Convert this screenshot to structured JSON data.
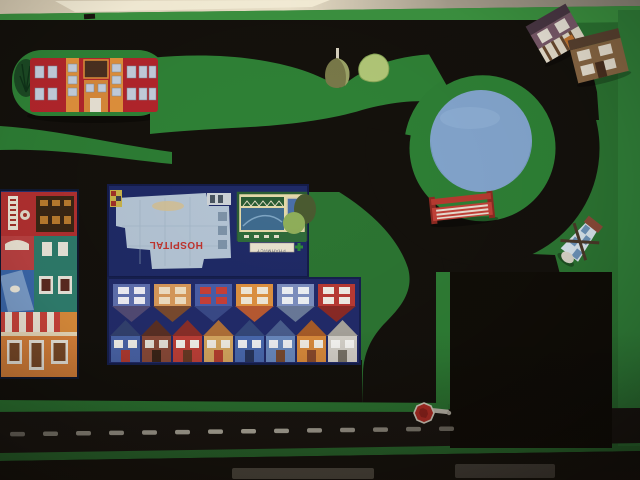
{
  "scene": {
    "description": "photo of a hand-painted toy-car play table: green board, black roads, roundabout with pond, hospital block, row houses, shop fronts, toy props",
    "labels": {
      "hospital": "HOSPITAL",
      "pharmacy": "PHARMACY"
    },
    "palette": {
      "board_green": "#2c7532",
      "board_green_bright": "#3c9340",
      "road_black": "#14110c",
      "bottom_road": "#1b1712",
      "parking_black": "#100d07",
      "pond_blue": "#83a5cd",
      "block_navy": "#1f2a66",
      "school_red": "#b2252b",
      "school_orange": "#e0913c",
      "bench_red": "#b83a30",
      "stop_sign_red": "#c03028",
      "wall_beige": "#cbbfa8",
      "hospital_roof": "#b4c4d4",
      "hospital_text_red": "#c0342e",
      "pharmacy_cream": "#e4d9a8",
      "pharmacy_green": "#2a5c34"
    },
    "bottom_road": {
      "dash_count": 14,
      "dash_color": "#ddd8c8"
    },
    "houses": {
      "top_row_inverted": [
        {
          "body": "#5f6fae",
          "roof": "#524a74",
          "win": "#efeef5"
        },
        {
          "body": "#d8995a",
          "roof": "#7a4a2e",
          "win": "#f0dfc2"
        },
        {
          "body": "#4a5ea8",
          "roof": "#3a4a88",
          "win": "#c84038"
        },
        {
          "body": "#de9140",
          "roof": "#b85a32",
          "win": "#f0e8d8"
        },
        {
          "body": "#7d8fc0",
          "roof": "#6a7a9a",
          "win": "#eef1f5"
        },
        {
          "body": "#b93a34",
          "roof": "#8a2a26",
          "win": "#f0ece4"
        }
      ],
      "bottom_row": [
        {
          "body": "#4a64a8",
          "roof": "#32406e",
          "win": "#f4f2ec",
          "door": "#b03a30"
        },
        {
          "body": "#8a4a38",
          "roof": "#5a3024",
          "win": "#e8e4da",
          "door": "#3a2418"
        },
        {
          "body": "#c04038",
          "roof": "#8a2e28",
          "win": "#f6f4ee",
          "door": "#6a3a24"
        },
        {
          "body": "#d8a860",
          "roof": "#b07038",
          "win": "#f4f0e6",
          "door": "#b84030"
        },
        {
          "body": "#4a6ab0",
          "roof": "#34487a",
          "win": "#f2f3f6",
          "door": "#28365e"
        },
        {
          "body": "#6a8ac0",
          "roof": "#4a5e8e",
          "win": "#f2f3f6",
          "door": "#7a4a30"
        },
        {
          "body": "#dc8c3c",
          "roof": "#a85c28",
          "win": "#f6f2e8",
          "door": "#8a4a2c"
        },
        {
          "body": "#d8d4cc",
          "roof": "#a8a49c",
          "win": "#fbfaf7",
          "door": "#7a7468"
        }
      ]
    }
  }
}
